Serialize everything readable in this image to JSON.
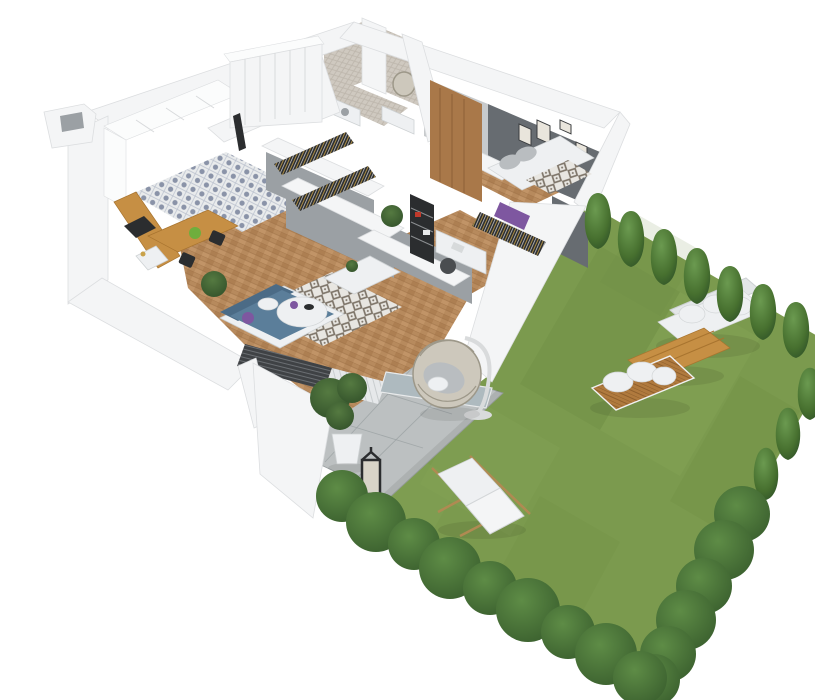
{
  "meta": {
    "description": "Photorealistic 3D isometric cutaway floor plan of a small apartment with a private fenced garden, viewed from above",
    "background": "#ffffff"
  },
  "palette": {
    "background": "#ffffff",
    "grass": "#7b9a4e",
    "grass-dark": "#66853d",
    "grass-light": "#8fae60",
    "hedge-dark": "#335729",
    "hedge-light": "#6b9a50",
    "bush-dark": "#3a5f2e",
    "bush-light": "#5e8c46",
    "paver": "#bcc0c1",
    "paver-line": "#9aa0a2",
    "wall-white": "#f4f5f6",
    "wall-edge": "#dcdee0",
    "wall-gray": "#c7cacc",
    "wall-mid": "#9ba0a4",
    "wall-dark": "#676c71",
    "wood-floor": "#b78a5d",
    "furniture-wood": "#c68f44",
    "wardrobe-wood": "#a97849",
    "sofa-blue": "#5b7e9a",
    "accent-purple": "#7e57a0",
    "cushion-white": "#eef0f2",
    "cushion-gray": "#b9bdc0",
    "rattan": "#cdc8bc",
    "rattan-dark": "#9d9889",
    "black": "#2b2d2f",
    "tile-blue": "#8a93a8",
    "bath-tile": "#cfc9c0"
  },
  "apartment": {
    "label": "Apartment interior (cutaway walls)",
    "rooms": [
      {
        "id": "kitchen",
        "label": "Kitchen",
        "items": [
          "white cabinet run",
          "wood countertop",
          "sink with gold tap",
          "dark cooktop",
          "patterned tile floor",
          "wood dining table",
          "green bowl",
          "two black chairs"
        ]
      },
      {
        "id": "entry-hall",
        "label": "Entry hall",
        "items": [
          "white wardrobe wall with door seams",
          "entry door",
          "patterned tile floor"
        ]
      },
      {
        "id": "bathroom",
        "label": "Bathroom",
        "items": [
          "herringbone tiled walls",
          "round mirror",
          "white vanity with basin",
          "washing machine"
        ]
      },
      {
        "id": "walk-in-closet",
        "label": "Walk-in closet",
        "items": [
          "two rails of hanging clothes",
          "gray partition walls",
          "potted plant"
        ]
      },
      {
        "id": "office",
        "label": "Office nook",
        "items": [
          "black shelving unit",
          "white desk with accessories",
          "desk chair",
          "tall wood wardrobe"
        ]
      },
      {
        "id": "bedroom",
        "label": "Bedroom",
        "items": [
          "double bed with white duvet",
          "gray pillows",
          "patterned blanket",
          "purple accents",
          "dark gray accent wall",
          "gallery wall with five frames",
          "clothes rail"
        ]
      },
      {
        "id": "living-room",
        "label": "Living room",
        "items": [
          "blue corner sofa with white frame",
          "purple cushion",
          "diamond pattern rug",
          "round white coffee table",
          "purple vase and dark bowl",
          "white media unit with plant",
          "dark louvered blinds",
          "sheer curtain panels",
          "glass door to patio",
          "herringbone wood floor",
          "potted plant"
        ]
      }
    ]
  },
  "garden": {
    "label": "Private garden",
    "items": [
      {
        "id": "lawn",
        "label": "Lawn"
      },
      {
        "id": "patio",
        "label": "Concrete paver patio"
      },
      {
        "id": "hedge-top",
        "label": "Conifer hedge along upper edge",
        "count": 8
      },
      {
        "id": "hedge-right",
        "label": "Tree and shrub row along right edge",
        "count": 9
      },
      {
        "id": "bush-row-bottom",
        "label": "Round bushes along lower edge",
        "count": 9
      },
      {
        "id": "garden-sofa-upper",
        "label": "White garden sofa with cushions"
      },
      {
        "id": "garden-sofa-lower",
        "label": "Wood-slat garden sofa with white cushions"
      },
      {
        "id": "garden-coffee-table",
        "label": "Rectangular wood coffee table"
      },
      {
        "id": "deck-chair",
        "label": "White canvas deck chair on lawn"
      },
      {
        "id": "hanging-egg-chair",
        "label": "Rattan hanging egg chair with stand"
      },
      {
        "id": "patio-plant",
        "label": "Potted tree in white planter"
      },
      {
        "id": "lantern",
        "label": "Black candle lantern"
      },
      {
        "id": "terrace-panel",
        "label": "White privacy wall panel"
      }
    ]
  }
}
